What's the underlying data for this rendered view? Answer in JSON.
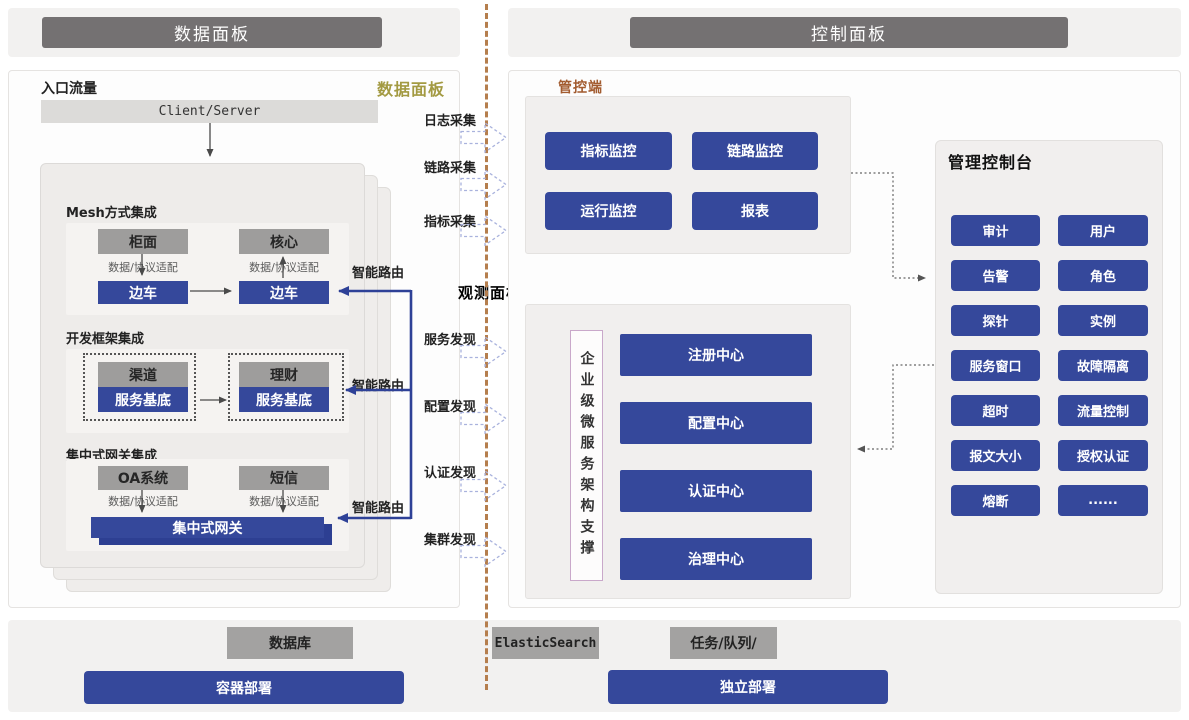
{
  "header": {
    "data_panel": "数据面板",
    "control_panel": "控制面板"
  },
  "data_plane": {
    "entry_label": "入口流量",
    "panel_tag": "数据面板",
    "client_server": "Client/Server",
    "adapter_label": "数据/协议适配",
    "smart_route": "智能路由",
    "mesh": {
      "title": "Mesh方式集成",
      "left_app": "柜面",
      "right_app": "核心",
      "left_sidecar": "边车",
      "right_sidecar": "边车"
    },
    "framework": {
      "title": "开发框架集成",
      "left_app": "渠道",
      "right_app": "理财",
      "left_base": "服务基底",
      "right_base": "服务基底"
    },
    "gateway": {
      "title": "集中式网关集成",
      "left_app": "OA系统",
      "right_app": "短信",
      "bar": "集中式网关"
    }
  },
  "middle": {
    "collect": [
      "日志采集",
      "链路采集",
      "指标采集"
    ],
    "observe_title": "观测面板",
    "discover": [
      "服务发现",
      "配置发现",
      "认证发现",
      "集群发现"
    ]
  },
  "control_plane": {
    "tag": "管控端",
    "monitor": [
      "指标监控",
      "链路监控",
      "运行监控",
      "报表"
    ],
    "support": "企业级微服务架构支撑",
    "centers": [
      "注册中心",
      "配置中心",
      "认证中心",
      "治理中心"
    ],
    "console": {
      "title": "管理控制台",
      "items": [
        "审计",
        "用户",
        "告警",
        "角色",
        "探针",
        "实例",
        "服务窗口",
        "故障隔离",
        "超时",
        "流量控制",
        "报文大小",
        "授权认证",
        "熔断",
        "......"
      ]
    }
  },
  "footer": {
    "database": "数据库",
    "container": "容器部署",
    "elastic": "ElasticSearch",
    "queue": "任务/队列/",
    "standalone": "独立部署"
  },
  "colors": {
    "accent_blue": "#35489b",
    "route_blue": "#2e4197",
    "dark_header": "#747172",
    "gold": "#a39a42",
    "brown": "#a25b2f",
    "divider": "#b57e4d"
  }
}
